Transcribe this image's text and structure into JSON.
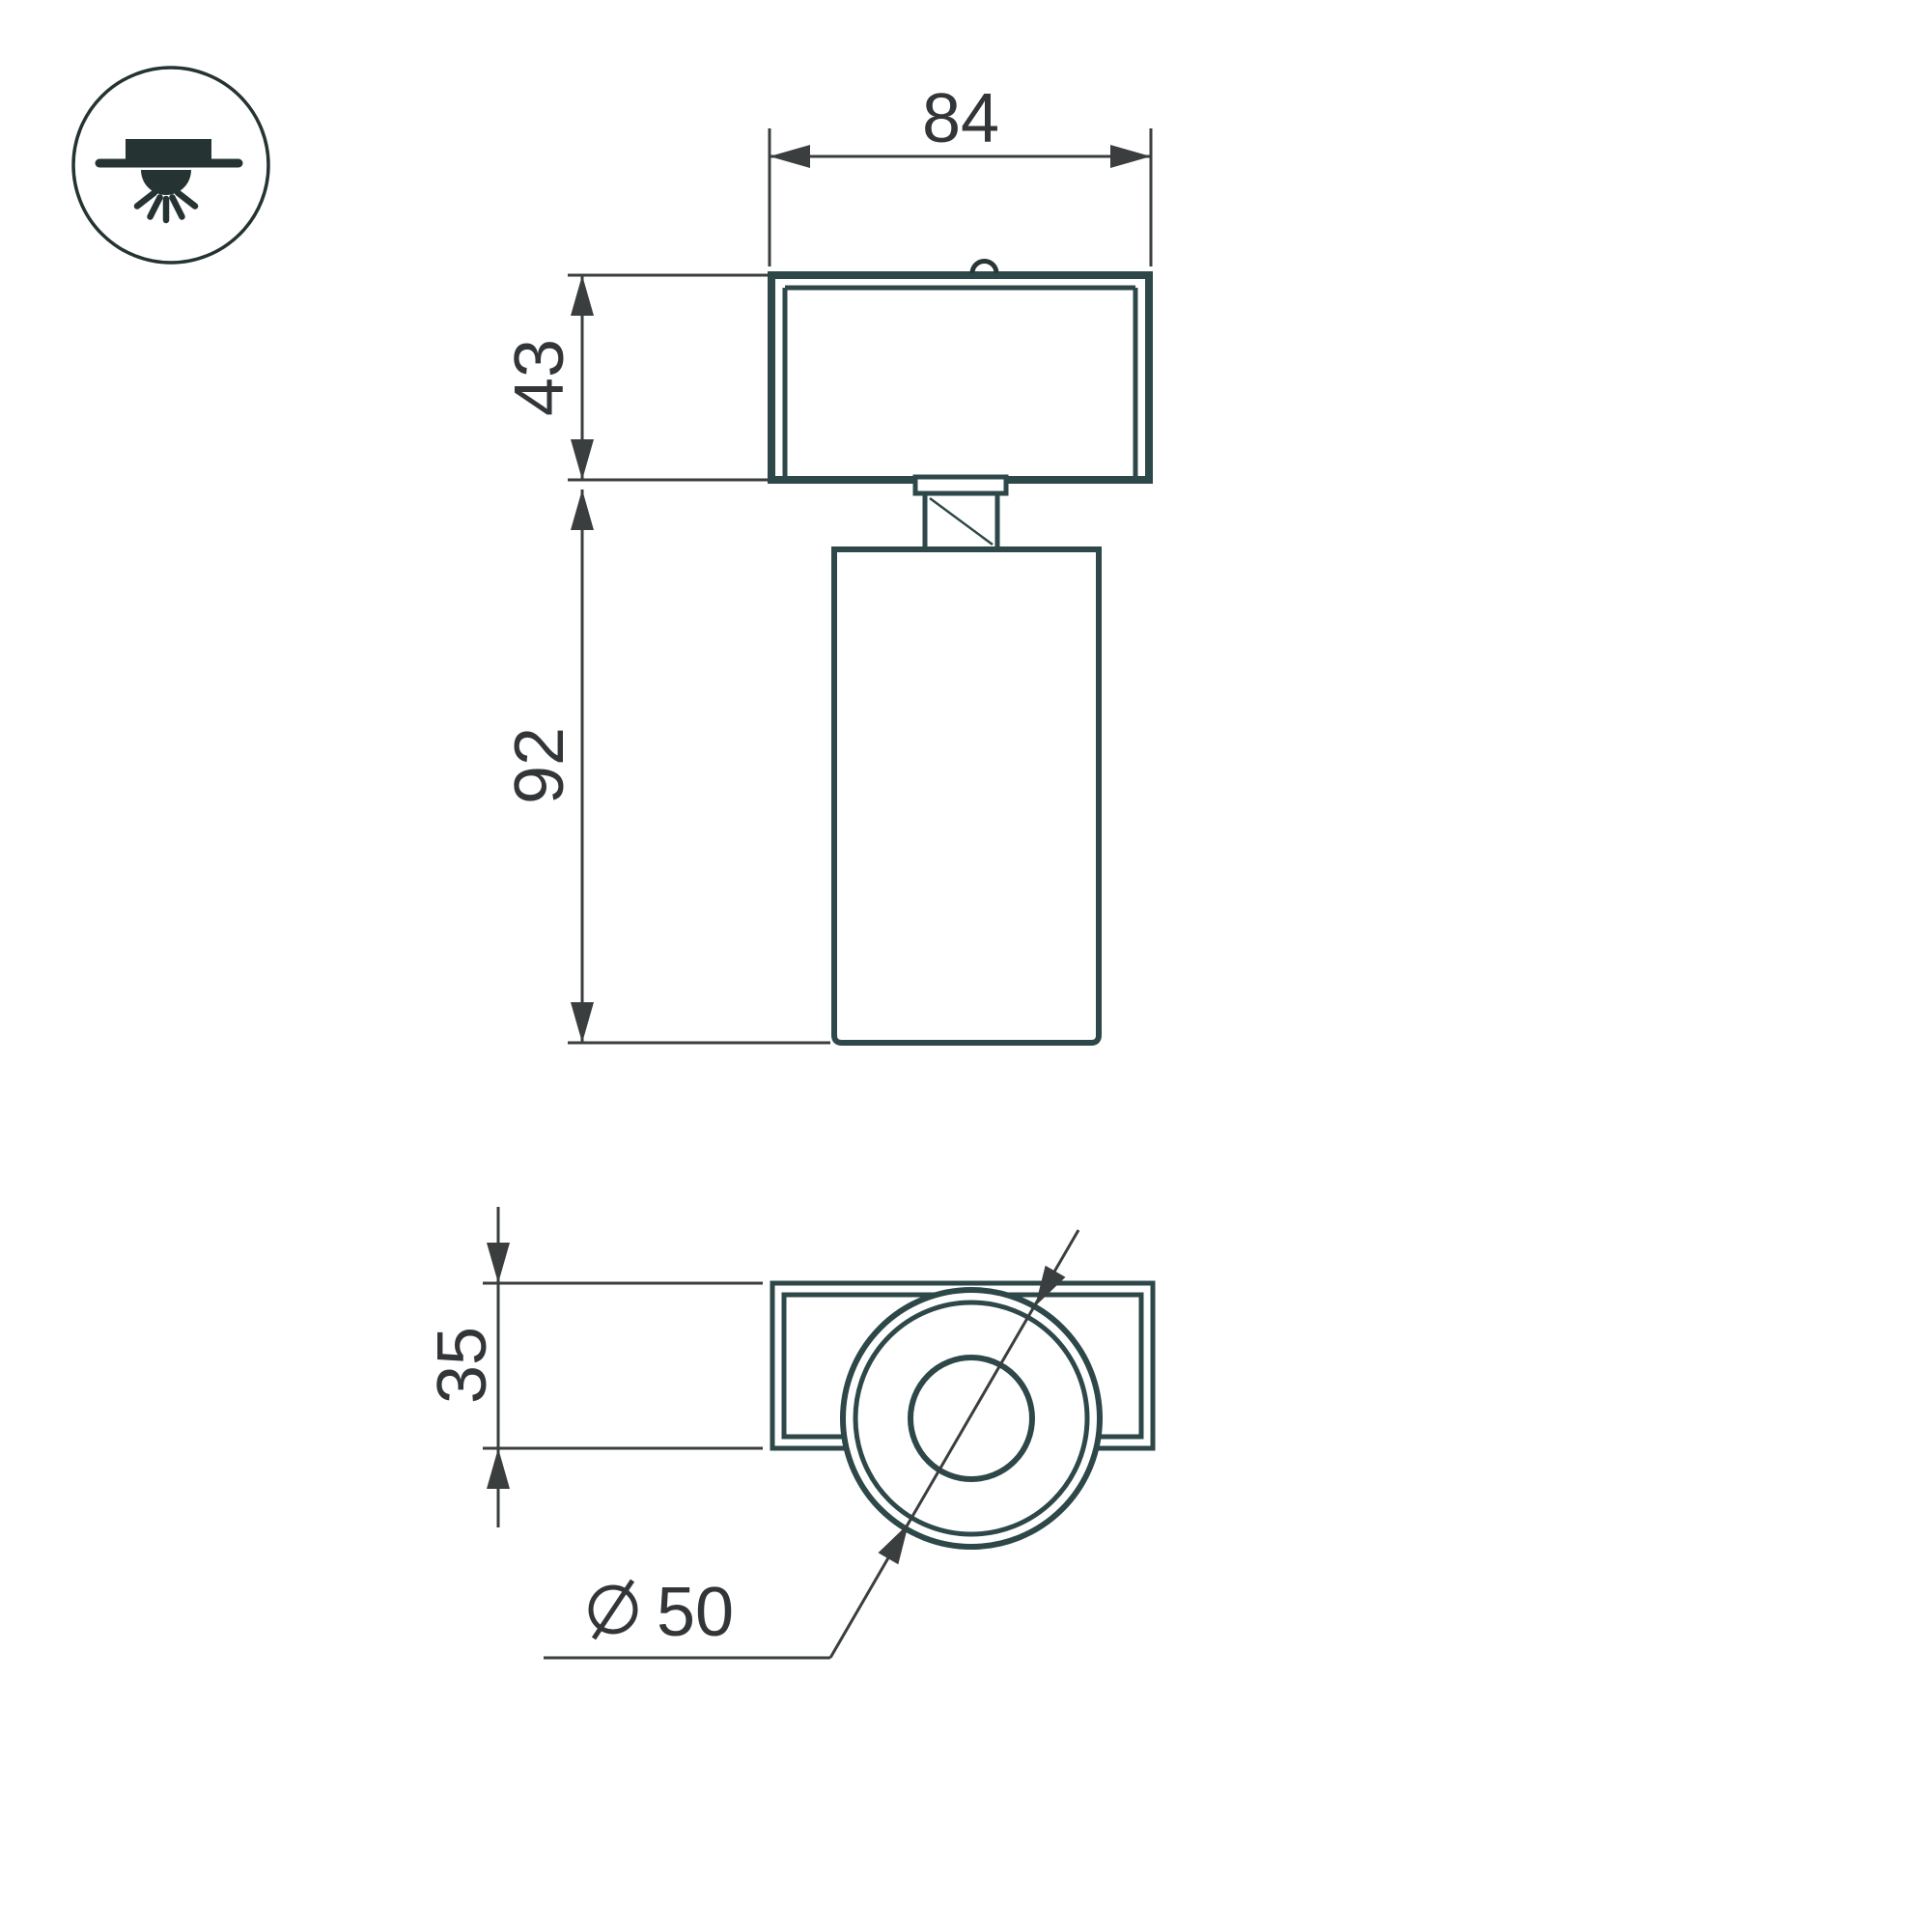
{
  "colors": {
    "background": "#ffffff",
    "drawing_line": "#2e4748",
    "dimension_line": "#3a3e3e",
    "text": "#333638",
    "icon": "#263333"
  },
  "mount_icon": {
    "name": "surface-mounted-ceiling-light-icon"
  },
  "front_view": {
    "width_mm": "84",
    "bracket_height_mm": "43",
    "body_height_mm": "92"
  },
  "bottom_view": {
    "bracket_depth_mm": "35",
    "body_diameter_mm": "50",
    "diameter_sign": "⌀"
  }
}
